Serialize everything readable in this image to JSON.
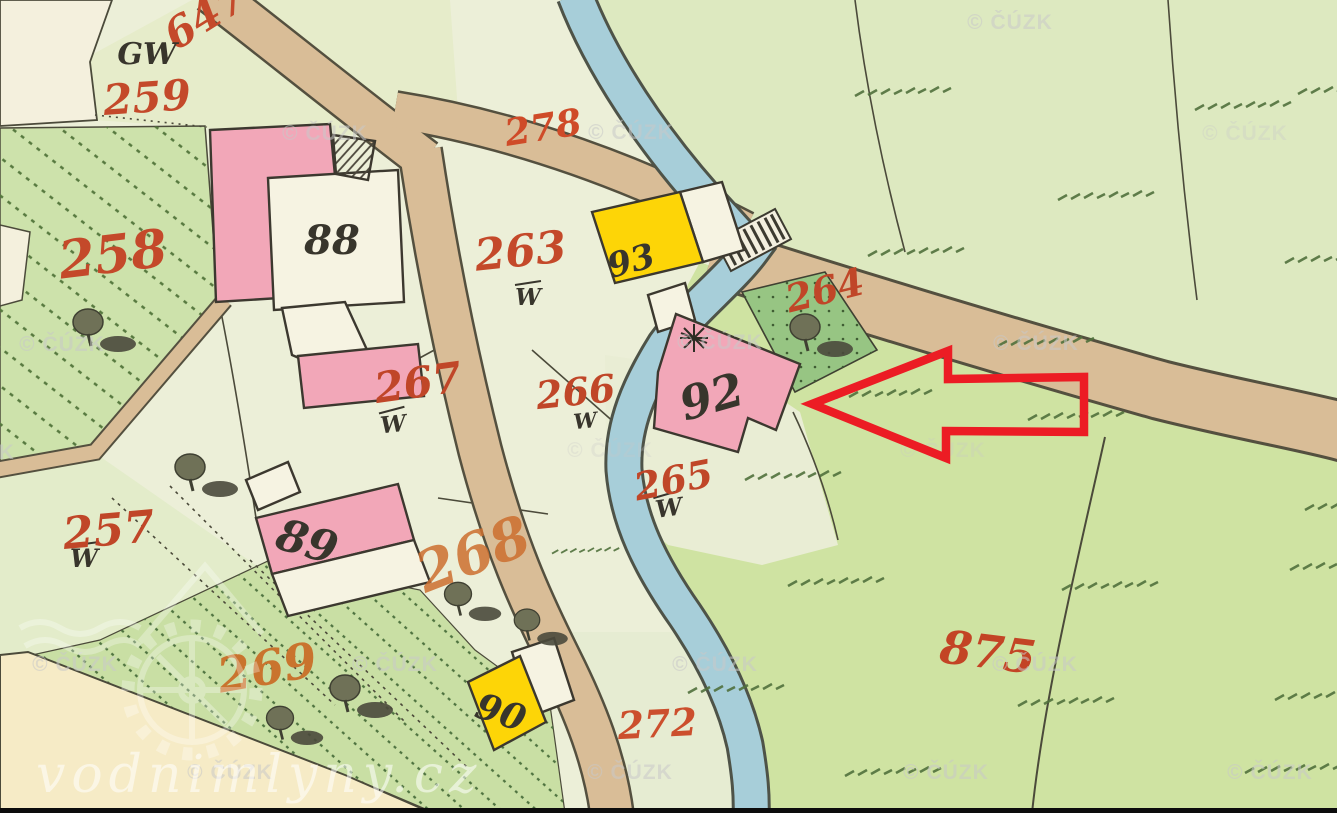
{
  "map": {
    "title": "historical cadastral map",
    "watermark_small": "© ČÚZK",
    "watermark_large": "vodnimlyny.cz",
    "labels": {
      "gw": "GW",
      "w": "W"
    },
    "parcel_numbers": {
      "p647": "647",
      "p259": "259",
      "p258": "258",
      "p257": "257",
      "p263": "263",
      "p264": "264",
      "p265": "265",
      "p266": "266",
      "p267": "267",
      "p268": "268",
      "p269": "269",
      "p272": "272",
      "p278": "278",
      "p875": "875"
    },
    "building_numbers": {
      "b88": "88",
      "b89": "89",
      "b90": "90",
      "b92": "92",
      "b93": "93"
    },
    "colors": {
      "background": "#ecefd8",
      "meadow": "#cfe3a2",
      "meadow_top": "#dde9c0",
      "hatched_green": "#cde2ab",
      "garden_green": "#97c583",
      "road": "#d9bd97",
      "stream": "#a7ced9",
      "building_pink": "#f2a7b8",
      "building_yellow": "#fdd507",
      "building_white": "#f6f3e2",
      "number_red": "#c4492a",
      "number_orange": "#c9742e",
      "number_black": "#38352c",
      "arrow_red": "#ec1c24",
      "watermark_gray": "#c8c8c8",
      "wedge_cream": "#f6ebc6"
    }
  }
}
